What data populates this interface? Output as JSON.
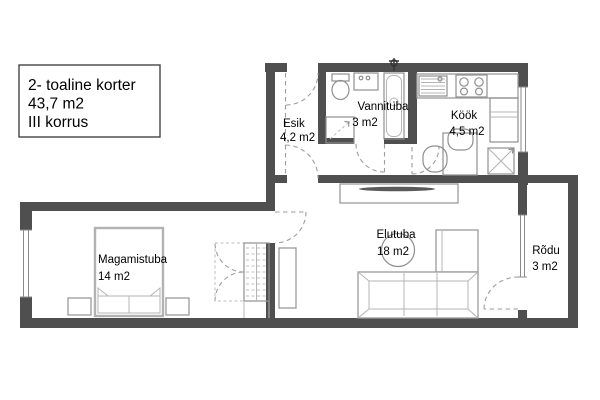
{
  "title_box": {
    "line1": "2- toaline korter",
    "line2": "43,7 m2",
    "line3": "III korrus"
  },
  "rooms": {
    "esik": {
      "name": "Esik",
      "area": "4,2 m2"
    },
    "vannituba": {
      "name": "Vannituba",
      "area": "3 m2"
    },
    "kook": {
      "name": "Köök",
      "area": "4,5 m2"
    },
    "magamistuba": {
      "name": "Magamistuba",
      "area": "14 m2"
    },
    "elutuba": {
      "name": "Elutuba",
      "area": "18 m2"
    },
    "rodu": {
      "name": "Rõdu",
      "area": "3 m2"
    }
  },
  "colors": {
    "wall": "#4f4f4f",
    "background": "#ffffff",
    "text": "#000000",
    "furniture_outline": "#9a9a9a",
    "door_swing": "#9e9e9e"
  }
}
